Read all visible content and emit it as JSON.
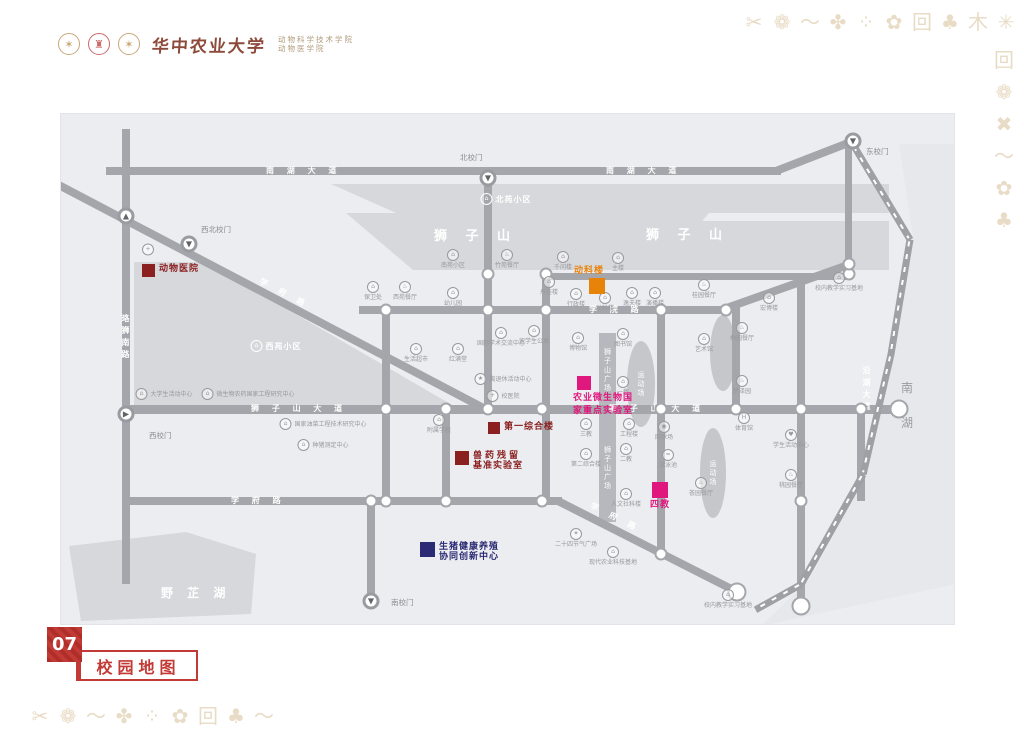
{
  "header": {
    "university": "华中农业大学",
    "college_line1": "动物科学技术学院",
    "college_line2": "动物医学院"
  },
  "footer": {
    "page_number": "07",
    "title": "校园地图"
  },
  "colors": {
    "dark_red": "#8b2020",
    "orange": "#e8830a",
    "magenta": "#e0187d",
    "navy": "#2b2a74",
    "road_gray": "#a5a6ab",
    "map_bg": "#ecedf1",
    "decor_tan": "#e9dcc6",
    "brand_red": "#c23a35"
  },
  "decor": {
    "top_row": [
      "✂",
      "❁",
      "〜",
      "✤",
      "⁘",
      "✿",
      "回",
      "♣",
      "木",
      "✳",
      "✖"
    ],
    "right_col": [
      "回",
      "❁",
      "✖",
      "〜",
      "✿",
      "♣"
    ],
    "bottom_row": [
      "✂",
      "❁",
      "〜",
      "✤",
      "⁘",
      "✿",
      "回",
      "♣",
      "〜"
    ]
  },
  "map": {
    "areas": {
      "lion_hill_west": "狮  子  山",
      "lion_hill_east": "狮  子  山",
      "beiyuan": "北苑小区",
      "xiyuan": "西苑小区",
      "yezhi_lake": "野 芷 湖",
      "south_lake_1": "南",
      "south_lake_2": "湖",
      "plaza": "狮子山广场",
      "field": "运动场"
    },
    "road_labels": [
      {
        "x": 205,
        "y": 57,
        "t": "南 湖 大 道"
      },
      {
        "x": 545,
        "y": 57,
        "t": "南 湖 大 道"
      },
      {
        "x": 65,
        "y": 200,
        "t": "珞狮南路",
        "v": 1
      },
      {
        "x": 196,
        "y": 180,
        "t": "学 府 路",
        "rot": 27.7
      },
      {
        "x": 528,
        "y": 196,
        "t": "学 院 路"
      },
      {
        "x": 190,
        "y": 295,
        "t": "狮 子 山 大 道"
      },
      {
        "x": 548,
        "y": 295,
        "t": "狮 子 山 大 道"
      },
      {
        "x": 170,
        "y": 387,
        "t": "学 府 路"
      },
      {
        "x": 527,
        "y": 404,
        "t": "学 府 路",
        "rot": 26.9
      },
      {
        "x": 806,
        "y": 252,
        "t": "沿湖大道",
        "v": 1
      }
    ],
    "gates": [
      {
        "x": 427,
        "y": 64,
        "g": "▼",
        "label": "北校门",
        "lx": 399,
        "ly": 38
      },
      {
        "x": 792,
        "y": 27,
        "g": "▼",
        "label": "东校门",
        "lx": 805,
        "ly": 32
      },
      {
        "x": 128,
        "y": 130,
        "g": "▼",
        "label": "西北校门",
        "lx": 140,
        "ly": 110
      },
      {
        "x": 65,
        "y": 300,
        "g": "▶",
        "label": "西校门",
        "lx": 88,
        "ly": 316
      },
      {
        "x": 310,
        "y": 487,
        "g": "▼",
        "label": "南校门",
        "lx": 330,
        "ly": 483
      },
      {
        "x": 65,
        "y": 102,
        "g": "▲",
        "label": "",
        "lx": 0,
        "ly": 0
      }
    ],
    "nodes": [
      {
        "x": 427,
        "y": 160
      },
      {
        "x": 485,
        "y": 160
      },
      {
        "x": 788,
        "y": 160
      },
      {
        "x": 788,
        "y": 150
      },
      {
        "x": 325,
        "y": 196
      },
      {
        "x": 427,
        "y": 196
      },
      {
        "x": 485,
        "y": 196
      },
      {
        "x": 600,
        "y": 196
      },
      {
        "x": 665,
        "y": 196
      },
      {
        "x": 325,
        "y": 295
      },
      {
        "x": 385,
        "y": 295
      },
      {
        "x": 427,
        "y": 295
      },
      {
        "x": 481,
        "y": 295
      },
      {
        "x": 600,
        "y": 295
      },
      {
        "x": 675,
        "y": 295
      },
      {
        "x": 740,
        "y": 295
      },
      {
        "x": 800,
        "y": 295
      },
      {
        "x": 310,
        "y": 387
      },
      {
        "x": 325,
        "y": 387
      },
      {
        "x": 385,
        "y": 387
      },
      {
        "x": 481,
        "y": 387
      },
      {
        "x": 740,
        "y": 387
      },
      {
        "x": 600,
        "y": 440
      },
      {
        "x": 838,
        "y": 295,
        "big": 1
      },
      {
        "x": 676,
        "y": 478,
        "big": 1
      },
      {
        "x": 740,
        "y": 492,
        "big": 1
      }
    ],
    "highlights": {
      "animal_hospital": {
        "label": "动物医院"
      },
      "dongke_building": {
        "label": "动科楼"
      },
      "agri_micro_lab": {
        "line1": "农业微生物国",
        "line2": "家重点实验室"
      },
      "first_complex": {
        "label": "第一综合楼"
      },
      "vet_drug_lab": {
        "line1": "兽药残留",
        "line2": "基准实验室"
      },
      "fourth_teaching": {
        "label": "四教"
      },
      "pig_center": {
        "line1": "生猪健康养殖",
        "line2": "协同创新中心"
      }
    },
    "pois": [
      {
        "x": 312,
        "y": 177,
        "l": "保卫处"
      },
      {
        "x": 344,
        "y": 177,
        "l": "西苑餐厅",
        "g": "♨"
      },
      {
        "x": 392,
        "y": 183,
        "l": "幼儿园"
      },
      {
        "x": 392,
        "y": 145,
        "l": "南苑小区"
      },
      {
        "x": 446,
        "y": 145,
        "l": "竹苑餐厅",
        "g": "♨"
      },
      {
        "x": 502,
        "y": 147,
        "l": "千问楼"
      },
      {
        "x": 557,
        "y": 148,
        "l": "主楼"
      },
      {
        "x": 488,
        "y": 172,
        "l": "丹桂楼"
      },
      {
        "x": 515,
        "y": 184,
        "l": "行政楼"
      },
      {
        "x": 544,
        "y": 188,
        "l": "动科楼"
      },
      {
        "x": 571,
        "y": 183,
        "l": "逸夫楼"
      },
      {
        "x": 594,
        "y": 183,
        "l": "演播楼"
      },
      {
        "x": 643,
        "y": 175,
        "l": "桂园餐厅",
        "g": "♨"
      },
      {
        "x": 708,
        "y": 188,
        "l": "宏博楼"
      },
      {
        "x": 778,
        "y": 168,
        "l": "校内教学实习基地",
        "c": "b2"
      },
      {
        "x": 103,
        "y": 280,
        "l": "大学生活动中心",
        "c": "r"
      },
      {
        "x": 187,
        "y": 280,
        "l": "微生物农药国家工程研究中心",
        "c": "r"
      },
      {
        "x": 355,
        "y": 239,
        "l": "生活超市"
      },
      {
        "x": 397,
        "y": 239,
        "l": "红满堂"
      },
      {
        "x": 440,
        "y": 223,
        "l": "国际学术交流中心",
        "c": "b2"
      },
      {
        "x": 473,
        "y": 221,
        "l": "留学生公寓"
      },
      {
        "x": 442,
        "y": 265,
        "l": "离退休活动中心",
        "g": "★",
        "c": "r"
      },
      {
        "x": 442,
        "y": 282,
        "l": "校医院",
        "g": "+",
        "c": "r"
      },
      {
        "x": 517,
        "y": 228,
        "l": "博物馆"
      },
      {
        "x": 562,
        "y": 224,
        "l": "图书馆"
      },
      {
        "x": 562,
        "y": 272,
        "l": "一教"
      },
      {
        "x": 565,
        "y": 339,
        "l": "二教"
      },
      {
        "x": 643,
        "y": 229,
        "l": "艺术馆"
      },
      {
        "x": 681,
        "y": 218,
        "l": "梅园餐厅",
        "g": "♨"
      },
      {
        "x": 681,
        "y": 271,
        "l": "梦泽园",
        "g": "♨"
      },
      {
        "x": 683,
        "y": 308,
        "l": "体育馆",
        "g": "H"
      },
      {
        "x": 378,
        "y": 310,
        "l": "附属学校"
      },
      {
        "x": 262,
        "y": 310,
        "l": "国家油菜工程技术研究中心",
        "c": "r"
      },
      {
        "x": 262,
        "y": 331,
        "l": "种猪测定中心",
        "c": "r"
      },
      {
        "x": 525,
        "y": 314,
        "l": "三教"
      },
      {
        "x": 525,
        "y": 344,
        "l": "第二综合楼"
      },
      {
        "x": 568,
        "y": 314,
        "l": "工程楼"
      },
      {
        "x": 603,
        "y": 317,
        "l": "网球场",
        "g": "◉"
      },
      {
        "x": 607,
        "y": 345,
        "l": "游泳池",
        "g": "≈"
      },
      {
        "x": 565,
        "y": 384,
        "l": "人文社科楼"
      },
      {
        "x": 515,
        "y": 424,
        "l": "二十四节气广场",
        "g": "✦"
      },
      {
        "x": 640,
        "y": 373,
        "l": "荟园餐厅",
        "g": "♨"
      },
      {
        "x": 730,
        "y": 325,
        "l": "学生活动中心",
        "g": "♥"
      },
      {
        "x": 730,
        "y": 365,
        "l": "桃园餐厅",
        "g": "♨"
      },
      {
        "x": 552,
        "y": 442,
        "l": "现代农业科技基地",
        "c": "b2"
      },
      {
        "x": 667,
        "y": 485,
        "l": "校内教学实习基地",
        "c": "b2"
      },
      {
        "x": 87,
        "y": 136,
        "l": "",
        "g": "+"
      },
      {
        "x": 445,
        "y": 85,
        "l": "北苑小区",
        "c": "wr"
      },
      {
        "x": 215,
        "y": 232,
        "l": "西苑小区",
        "c": "wr"
      }
    ]
  }
}
